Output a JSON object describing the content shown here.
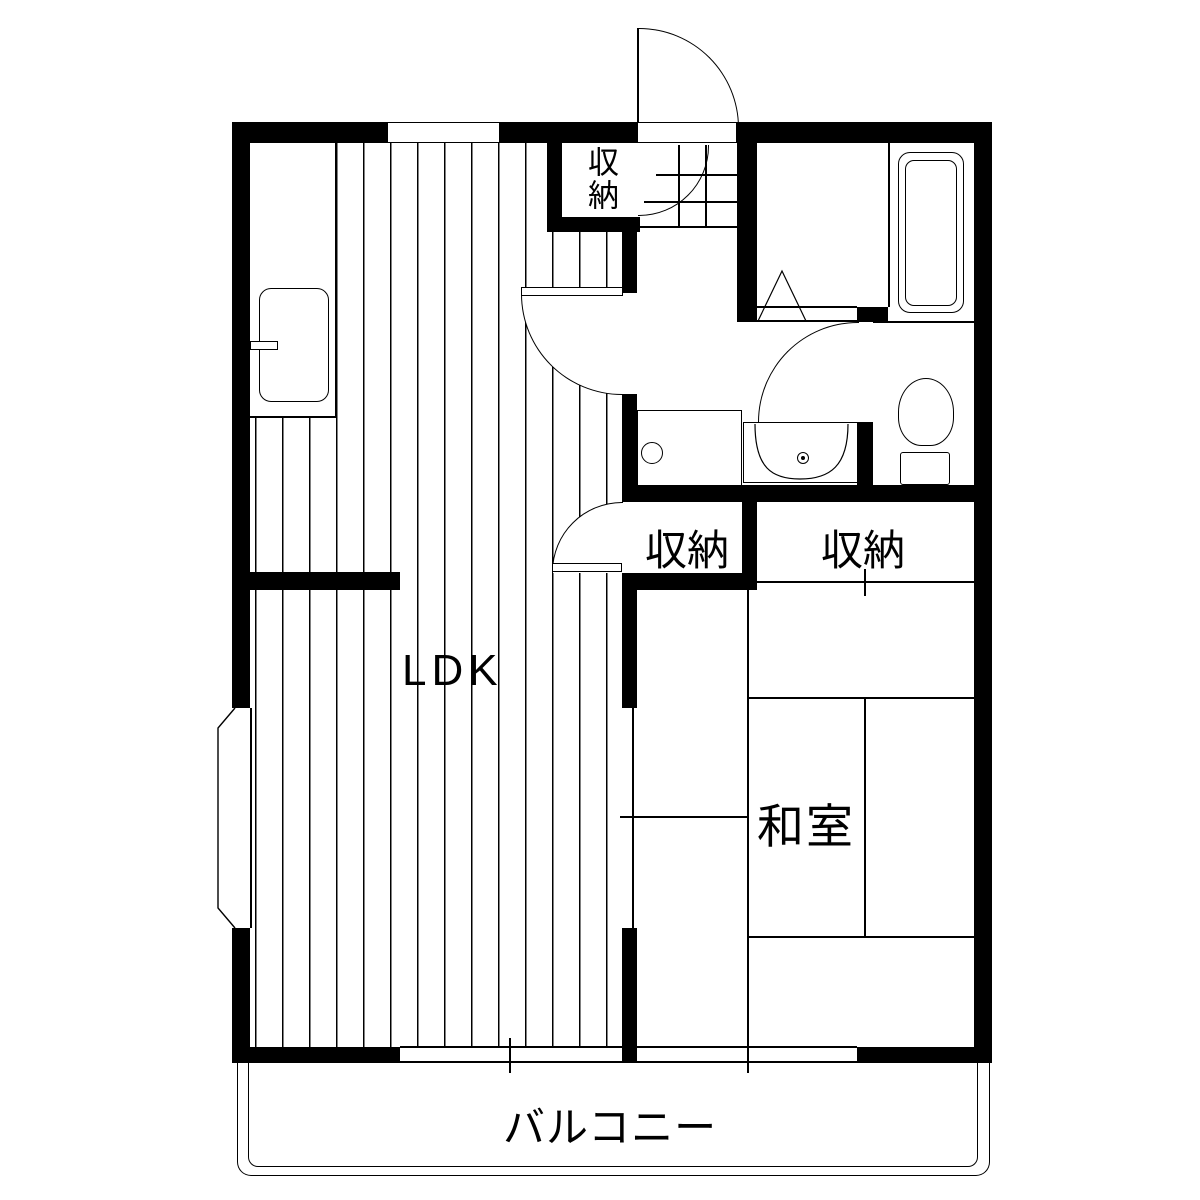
{
  "floorplan": {
    "rooms": {
      "ldk": "LDK",
      "washitsu": "和室",
      "storage": "収納",
      "balcony": "バルコニー"
    },
    "colors": {
      "wall": "#000000",
      "background": "#ffffff"
    }
  }
}
